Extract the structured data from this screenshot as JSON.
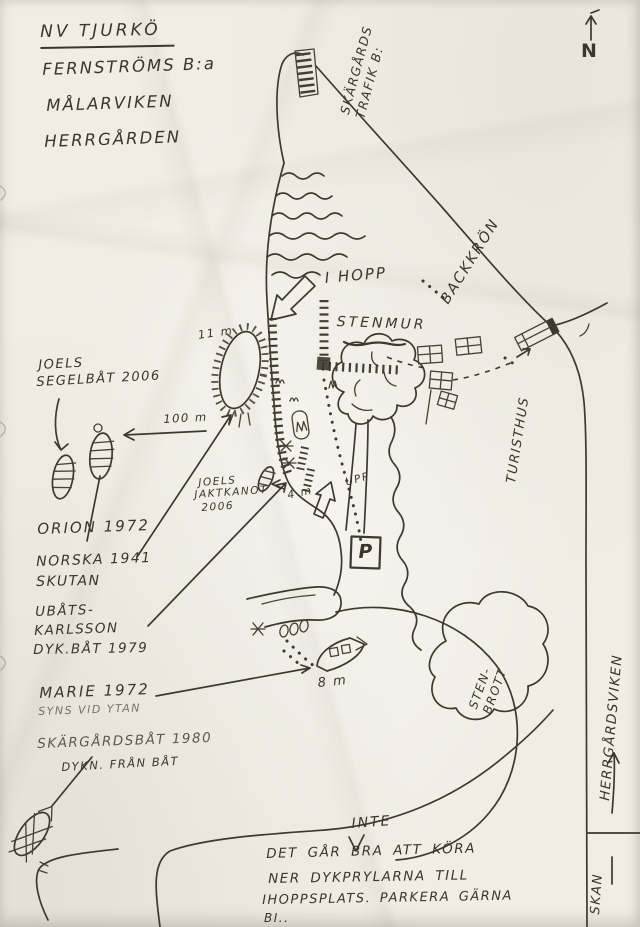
{
  "map": {
    "title_block": {
      "line1": "NV TJURKÖ",
      "line2": "FERNSTRÖMS B:a",
      "line3": "MÅLARVIKEN",
      "line4": "HERRGÅRDEN"
    },
    "compass_n": "N",
    "roads": {
      "skargards_trafik_line1": "SKÄRGÅRDS",
      "skargards_trafik_line2": "TRAFIK B:",
      "backkron": "BACKKRÖN"
    },
    "features": {
      "i_hopp": "I HOPP",
      "stenmur": "STENMUR",
      "turisthus": "TURISTHUS",
      "upp": "UPP",
      "parking": "P",
      "stenbrott_line1": "STEN-",
      "stenbrott_line2": "BROTT",
      "herrgardsviken": "HERRGÅRDSVIKEN",
      "skan": "SKAN"
    },
    "wrecks": {
      "joels_segelbat": {
        "line1": "JOELS",
        "line2": "SEGELBÅT 2006"
      },
      "joels_jaktkanot": {
        "line1": "JOELS",
        "line2": "JAKTKANOT",
        "line3": "2006"
      },
      "orion": "ORION 1972",
      "norska": {
        "line1": "NORSKA 1941",
        "line2": "SKUTAN"
      },
      "ubats": {
        "line1": "UBÅTS-",
        "line2": "KARLSSON",
        "line3": "DYK.BÅT 1979"
      },
      "marie": {
        "line1": "MARIE 1972",
        "line2": "SYNS VID YTAN"
      },
      "skargardsbat": {
        "line1": "SKÄRGÅRDSBÅT 1980",
        "line2": "DYKN. FRÅN BÅT"
      }
    },
    "measurements": {
      "depth_11m": "11 m",
      "depth_4m": "4 m",
      "depth_8m": "8 m",
      "distance_100m": "100 m"
    },
    "note": {
      "inserted": "INTE",
      "line1": "DET GÅR BRA ATT KÖRA",
      "line2": "NER DYKPRYLARNA TILL",
      "line3": "IHOPPSPLATS. PARKERA GÄRNA",
      "line4": "BI.."
    },
    "ink_color": "#3b362c",
    "paper_color": "#f1ede5"
  }
}
